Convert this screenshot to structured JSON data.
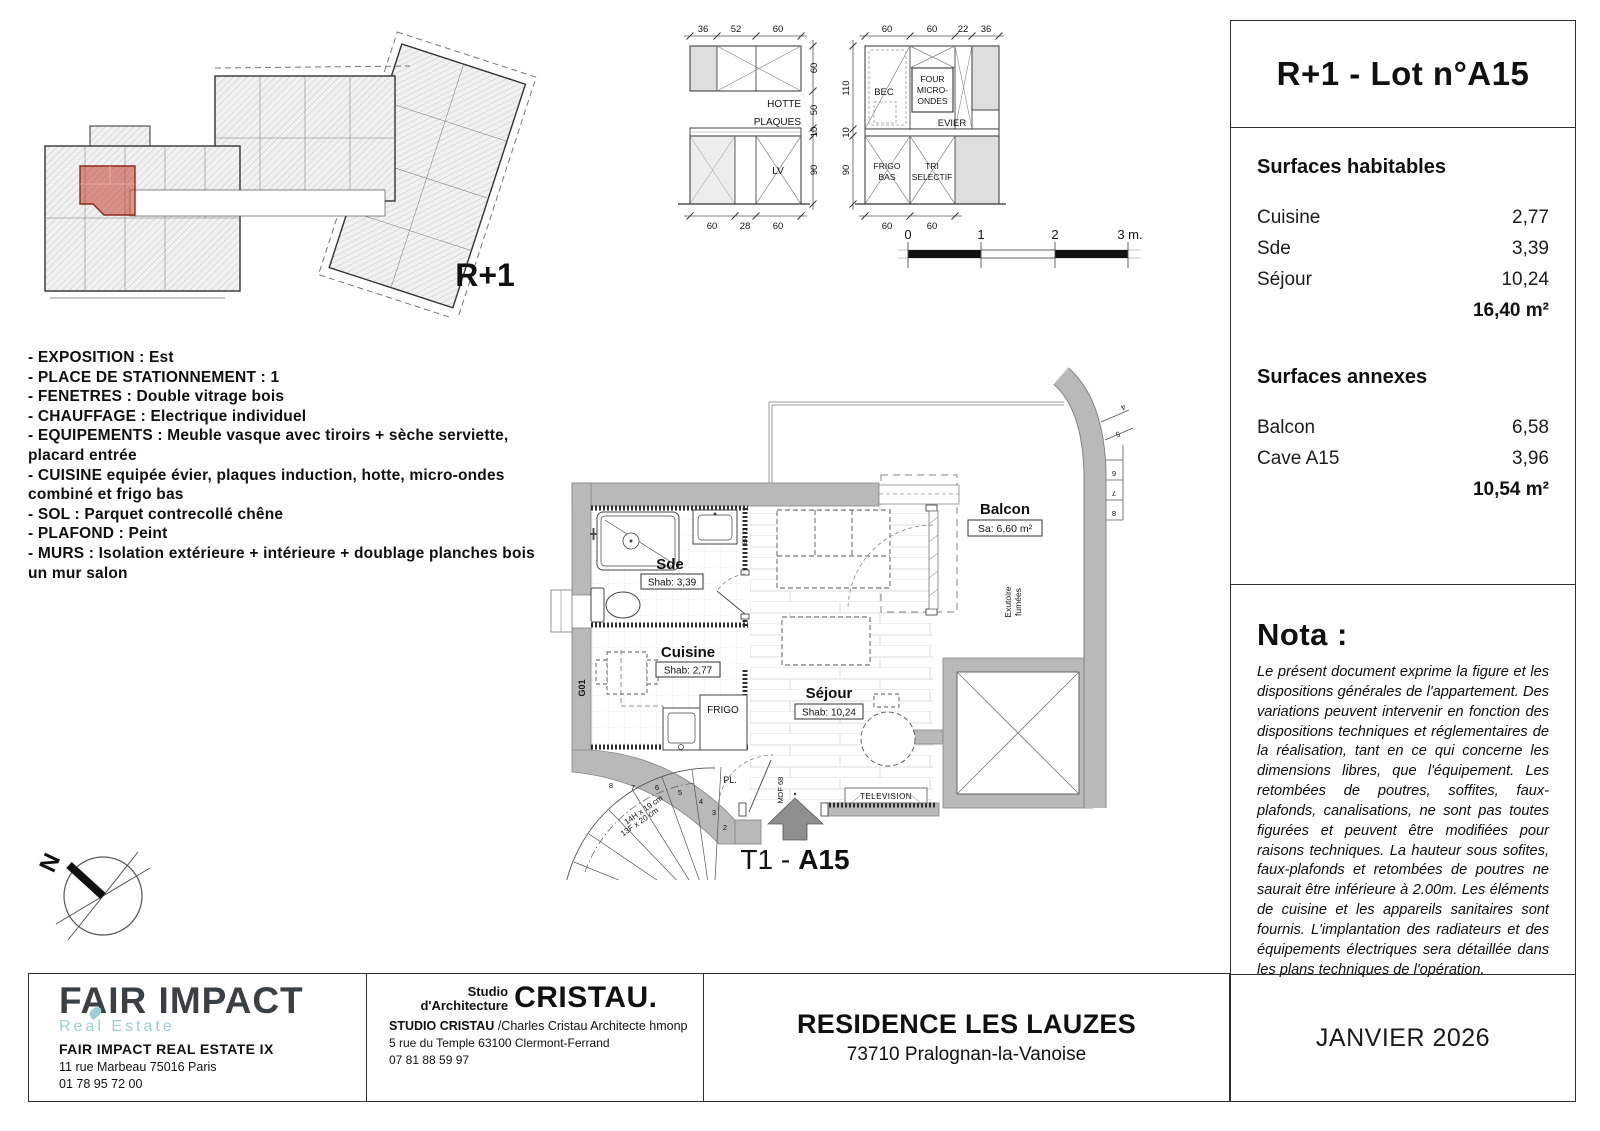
{
  "lot": {
    "title": "R+1 - Lot n°A15",
    "type_label": "T1 -",
    "lot_bold": "A15"
  },
  "date": "JANVIER 2026",
  "surfaces": {
    "habitables": {
      "heading": "Surfaces habitables",
      "rows": [
        {
          "label": "Cuisine",
          "value": "2,77"
        },
        {
          "label": "Sde",
          "value": "3,39"
        },
        {
          "label": "Séjour",
          "value": "10,24"
        }
      ],
      "total": "16,40 m²"
    },
    "annexes": {
      "heading": "Surfaces annexes",
      "rows": [
        {
          "label": "Balcon",
          "value": "6,58"
        },
        {
          "label": "Cave A15",
          "value": "3,96"
        }
      ],
      "total": "10,54 m²"
    }
  },
  "nota": {
    "heading": "Nota :",
    "body": "Le présent document exprime la figure et les dispositions générales de l'appartement. Des variations peuvent intervenir en fonction des dispositions techniques et réglementaires de la réalisation, tant en ce qui concerne les dimensions libres, que l'équipement. Les retombées de poutres, soffites, faux-plafonds, canalisations, ne sont pas toutes figurées et peuvent être modifiées pour raisons techniques. La hauteur sous sofites, faux-plafonds et retombées de poutres ne saurait être inférieure à 2.00m. Les éléments de cuisine et les appareils sanitaires sont fournis. L'implantation des radiateurs et des équipements électriques sera détaillée dans les plans techniques de l'opération."
  },
  "features": [
    "- EXPOSITION : Est",
    "- PLACE DE STATIONNEMENT : 1",
    "- FENETRES : Double vitrage bois",
    "- CHAUFFAGE : Electrique individuel",
    "- EQUIPEMENTS : Meuble vasque avec tiroirs + sèche serviette, placard entrée",
    "- CUISINE equipée évier, plaques induction, hotte, micro-ondes combiné et frigo bas",
    "- SOL : Parquet contrecollé chêne",
    "- PLAFOND : Peint",
    "- MURS : Isolation extérieure + intérieure + doublage planches bois un mur salon"
  ],
  "overview": {
    "floor_label": "R+1"
  },
  "kitchen_left": {
    "top_dims": [
      "36",
      "52",
      "60"
    ],
    "right_dims": [
      "60",
      "50",
      "10",
      "90"
    ],
    "bottom_dims": [
      "60",
      "28",
      "60"
    ],
    "labels": {
      "hotte": "HOTTE",
      "plaques": "PLAQUES",
      "lv": "LV"
    }
  },
  "kitchen_right": {
    "top_dims": [
      "60",
      "60",
      "22",
      "36"
    ],
    "left_dims": [
      "110",
      "10",
      "90"
    ],
    "bottom_dims": [
      "60",
      "60"
    ],
    "labels": {
      "four": "FOUR",
      "micro": "MICRO-",
      "ondes": "ONDES",
      "bec": "BEC",
      "evier": "EVIER",
      "frigo1": "FRIGO",
      "frigo2": "BAS",
      "tri1": "TRI",
      "tri2": "SELECTIF"
    }
  },
  "scalebar": {
    "t0": "0",
    "t1": "1",
    "t2": "2",
    "t3": "3 m."
  },
  "plan": {
    "sde": {
      "name": "Sde",
      "shab": "Shab: 3,39"
    },
    "cuisine": {
      "name": "Cuisine",
      "shab": "Shab: 2,77"
    },
    "sejour": {
      "name": "Séjour",
      "shab": "Shab: 10,24"
    },
    "balcon": {
      "name": "Balcon",
      "sa": "Sa: 6,60 m²"
    },
    "frigo": "FRIGO",
    "pl": "PL.",
    "mdf": "MDF 68",
    "g01": "G01",
    "tv": "TELEVISION",
    "bp": "BP 73",
    "exutoire_1": "Exutoire",
    "exutoire_2": "fumées",
    "stair_note_1": "14H x 19 cm",
    "stair_note_2": "13F x 20 cm",
    "stair_numbers": [
      "2",
      "3",
      "4",
      "5",
      "6",
      "7",
      "8"
    ],
    "upper_stair_numbers": [
      "4",
      "5",
      "6",
      "7",
      "8"
    ],
    "north": "N"
  },
  "footer": {
    "fair": {
      "logo_main": "FAIR IMPACT",
      "logo_sub": "Real Estate",
      "company": "FAIR IMPACT REAL ESTATE IX",
      "address": "11 rue Marbeau 75016 Paris",
      "phone": "01 78 95 72 00"
    },
    "studio": {
      "logo_line1": "Studio",
      "logo_line2": "d'Architecture",
      "logo_name": "CRISTAU.",
      "company": "STUDIO CRISTAU",
      "architect": "/Charles Cristau Architecte hmonp",
      "address": "5 rue du Temple 63100 Clermont-Ferrand",
      "phone": "07 81 88 59 97"
    },
    "project": {
      "name": "RESIDENCE LES LAUZES",
      "city": "73710 Pralognan-la-Vanoise"
    }
  },
  "colors": {
    "highlight_red": "#c0392b",
    "brand_teal": "#9ccfd4",
    "wall_gray": "#b9b9b9"
  }
}
